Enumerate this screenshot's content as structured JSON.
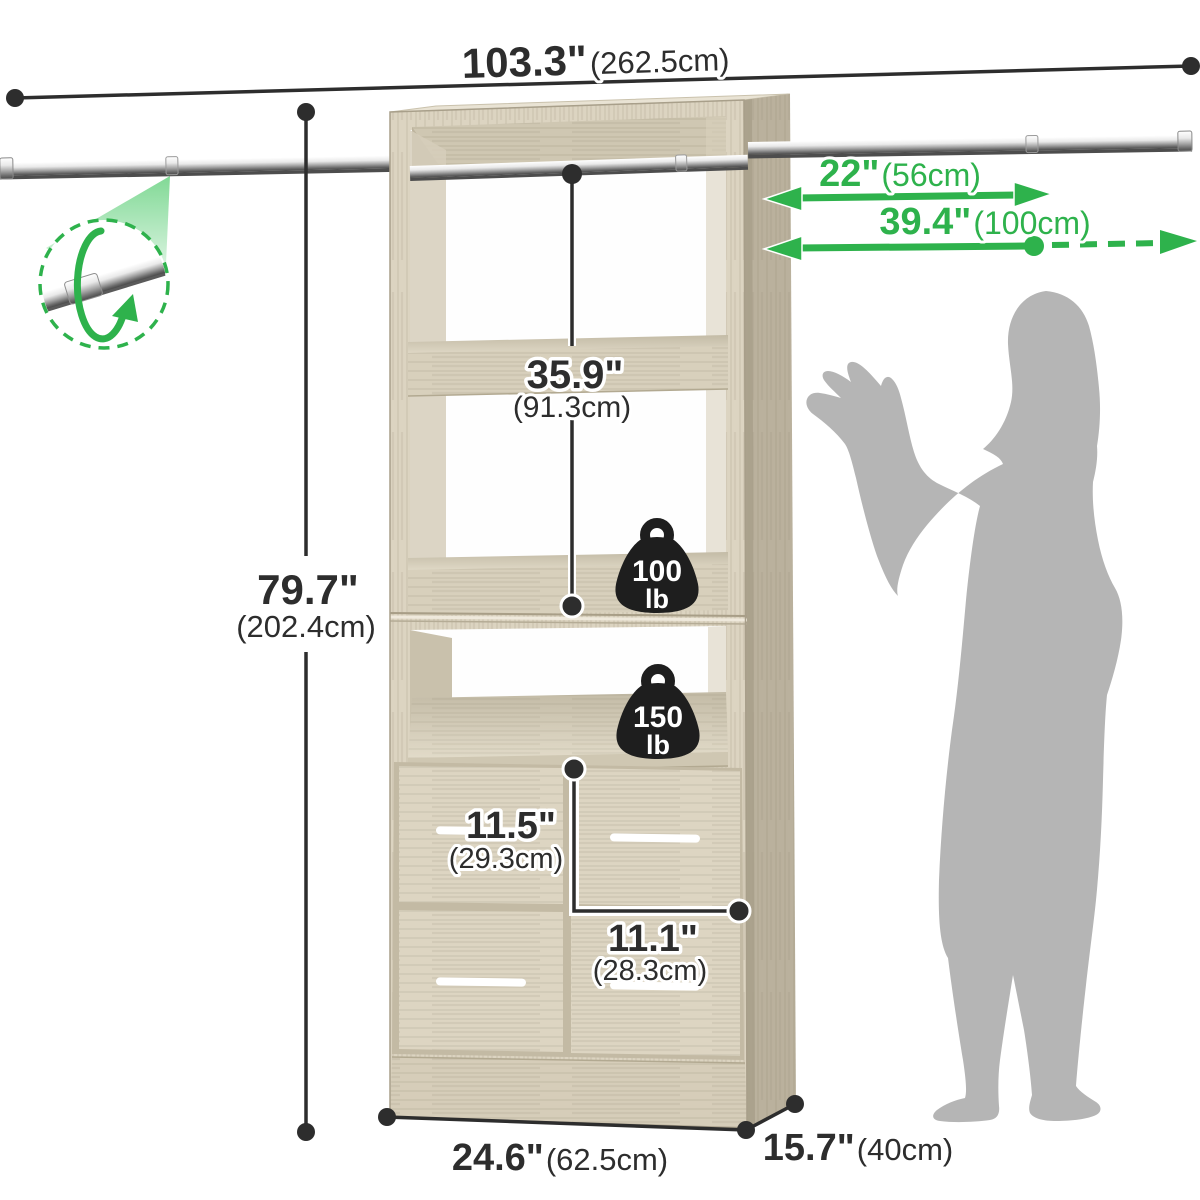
{
  "meta": {
    "description": "Dimension diagram of a wood closet organizer tower with two extendable metal hanging rods, two shelves, an open cubby and four drawers, shown next to a human silhouette for scale",
    "background": "#ffffff"
  },
  "colors": {
    "accent_green": "#2eb24c",
    "dimension_ink": "#2d2d2d",
    "wood_front": "#dcd4c1",
    "wood_side": "#bab19d",
    "wood_interior": "#cfc7b2",
    "wood_top": "#e9e3d4",
    "badge_black": "#1e1e1e",
    "silhouette_gray": "#b5b5b5",
    "handle_white": "#ffffff"
  },
  "labels": {
    "total_width": {
      "in": "103.3\"",
      "cm": "(262.5cm)"
    },
    "height": {
      "in": "79.7\"",
      "cm": "(202.4cm)"
    },
    "hanging_height": {
      "in": "35.9\"",
      "cm": "(91.3cm)"
    },
    "rod_retracted": {
      "in": "22\"",
      "cm": "(56cm)"
    },
    "rod_extended": {
      "in": "39.4\"",
      "cm": "(100cm)"
    },
    "drawer_height": {
      "in": "11.5\"",
      "cm": "(29.3cm)"
    },
    "drawer_width": {
      "in": "11.1\"",
      "cm": "(28.3cm)"
    },
    "tower_width": {
      "in": "24.6\"",
      "cm": "(62.5cm)"
    },
    "tower_depth": {
      "in": "15.7\"",
      "cm": "(40cm)"
    }
  },
  "capacities": {
    "upper_shelf": {
      "value": "100",
      "unit": "lb"
    },
    "lower_shelf": {
      "value": "150",
      "unit": "lb"
    }
  }
}
